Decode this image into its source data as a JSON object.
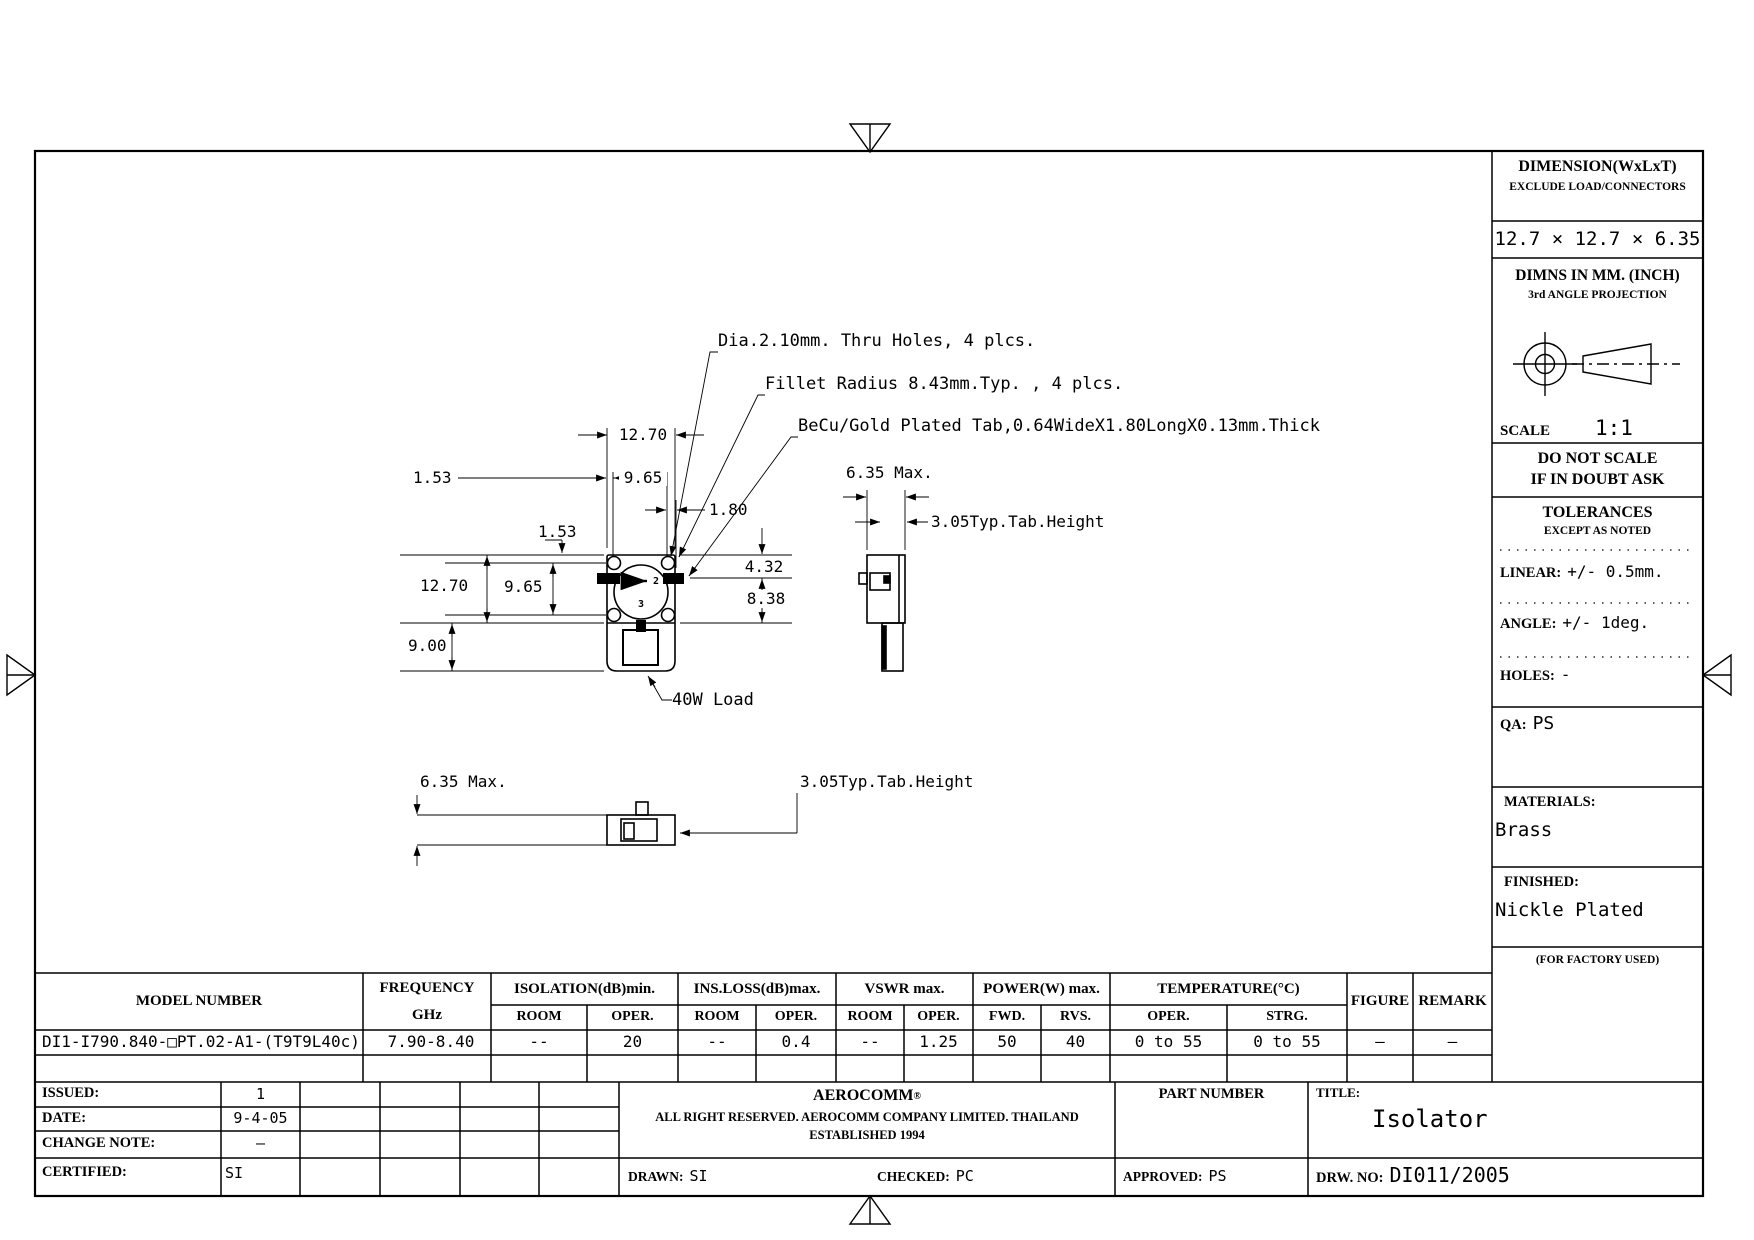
{
  "drawing": {
    "callout_dia": "Dia.2.10mm. Thru Holes, 4 plcs.",
    "callout_fillet": "Fillet Radius 8.43mm.Typ. , 4 plcs.",
    "callout_tab": "BeCu/Gold Plated Tab,0.64WideX1.80LongX0.13mm.Thick",
    "dim_top_width": "12.70",
    "dim_top_153": "1.53",
    "dim_top_965": "9.65",
    "dim_tab_180": "1.80",
    "dim_left_153": "1.53",
    "dim_left_1270": "12.70",
    "dim_left_965": "9.65",
    "dim_left_900": "9.00",
    "dim_right_432": "4.32",
    "dim_right_838": "8.38",
    "load_label": "40W Load",
    "side_width": "6.35 Max.",
    "side_tab": "3.05Typ.Tab.Height",
    "bottom_width": "6.35 Max.",
    "bottom_tab": "3.05Typ.Tab.Height",
    "port1": "1",
    "port2": "2",
    "port3": "3"
  },
  "title_block": {
    "dimension_header": "DIMENSION(WxLxT)",
    "dimension_sub": "EXCLUDE LOAD/CONNECTORS",
    "dimension_value": "12.7 × 12.7 × 6.35",
    "dimns_header": "DIMNS IN MM. (INCH)",
    "projection": "3rd ANGLE PROJECTION",
    "scale_label": "SCALE",
    "scale_value": "1:1",
    "do_not_scale_1": "DO NOT SCALE",
    "do_not_scale_2": "IF IN DOUBT ASK",
    "tolerances_header": "TOLERANCES",
    "tolerances_sub": "EXCEPT AS NOTED",
    "linear_label": "LINEAR:",
    "linear_value": "+/-  0.5mm.",
    "angle_label": "ANGLE:",
    "angle_value": "+/- 1deg.",
    "holes_label": "HOLES:",
    "holes_value": "-",
    "qa_label": "QA:",
    "qa_value": "PS",
    "materials_label": "MATERIALS:",
    "materials_value": "Brass",
    "finished_label": "FINISHED:",
    "finished_value": "Nickle Plated",
    "factory_note": "(FOR FACTORY USED)"
  },
  "spec_table": {
    "col_model": "MODEL NUMBER",
    "col_freq_1": "FREQUENCY",
    "col_freq_2": "GHz",
    "col_isolation": "ISOLATION(dB)min.",
    "col_insloss": "INS.LOSS(dB)max.",
    "col_vswr": "VSWR  max.",
    "col_power": "POWER(W)  max.",
    "col_temp": "TEMPERATURE(°C)",
    "col_room": "ROOM",
    "col_oper": "OPER.",
    "col_fwd": "FWD.",
    "col_rvs": "RVS.",
    "col_strg": "STRG.",
    "col_figure": "FIGURE",
    "col_remark": "REMARK",
    "row": {
      "model": "DI1-I790.840-□PT.02-A1-(T9T9L40c)",
      "freq": "7.90-8.40",
      "iso_room": "--",
      "iso_oper": "20",
      "ins_room": "--",
      "ins_oper": "0.4",
      "vswr_room": "--",
      "vswr_oper": "1.25",
      "pwr_fwd": "50",
      "pwr_rvs": "40",
      "temp_oper": "0 to 55",
      "temp_strg": "0 to 55",
      "figure": "—",
      "remark": "—"
    }
  },
  "footer": {
    "issued_label": "ISSUED:",
    "issued_value": "1",
    "date_label": "DATE:",
    "date_value": "9-4-05",
    "change_label": "CHANGE NOTE:",
    "change_value": "–",
    "certified_label": "CERTIFIED:",
    "certified_value": "SI",
    "company_name": "AEROCOMM",
    "company_reg": "®",
    "company_line1": "ALL RIGHT RESERVED. AEROCOMM COMPANY LIMITED. THAILAND",
    "company_line2": "ESTABLISHED 1994",
    "part_number_label": "PART NUMBER",
    "title_label": "TITLE:",
    "title_value": "Isolator",
    "drawn_label": "DRAWN:",
    "drawn_value": "SI",
    "checked_label": "CHECKED:",
    "checked_value": "PC",
    "approved_label": "APPROVED:",
    "approved_value": "PS",
    "drw_label": "DRW. NO:",
    "drw_value": "DI011/2005"
  }
}
